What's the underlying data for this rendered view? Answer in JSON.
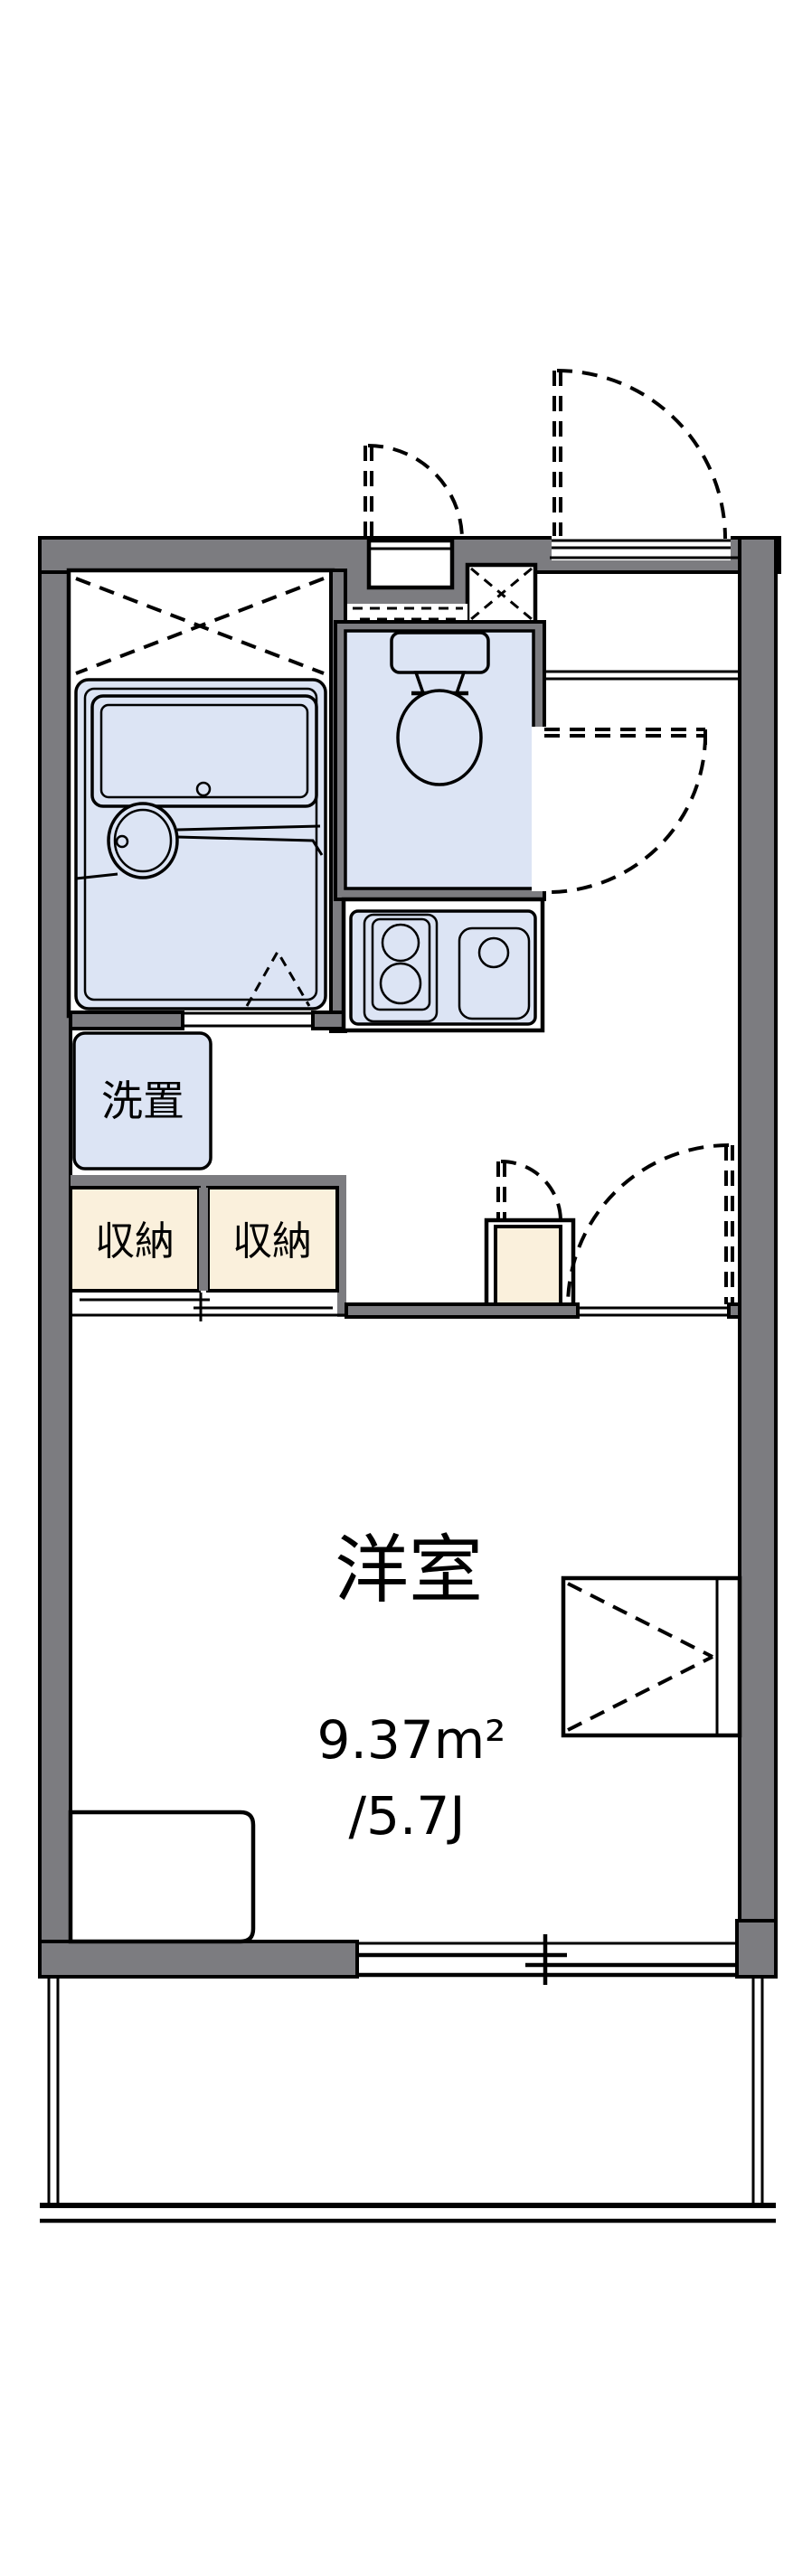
{
  "plan": {
    "room": {
      "name": "洋室",
      "area_m2": "9.37m²",
      "area_tatami": "/5.7J"
    },
    "labels": {
      "washer": "洗置",
      "storage_left": "収納",
      "storage_right": "収納"
    },
    "colors": {
      "wall": "#7c7c80",
      "water": "#dce4f4",
      "storage": "#faf0dc",
      "outline": "#000000",
      "bg": "#ffffff"
    }
  }
}
